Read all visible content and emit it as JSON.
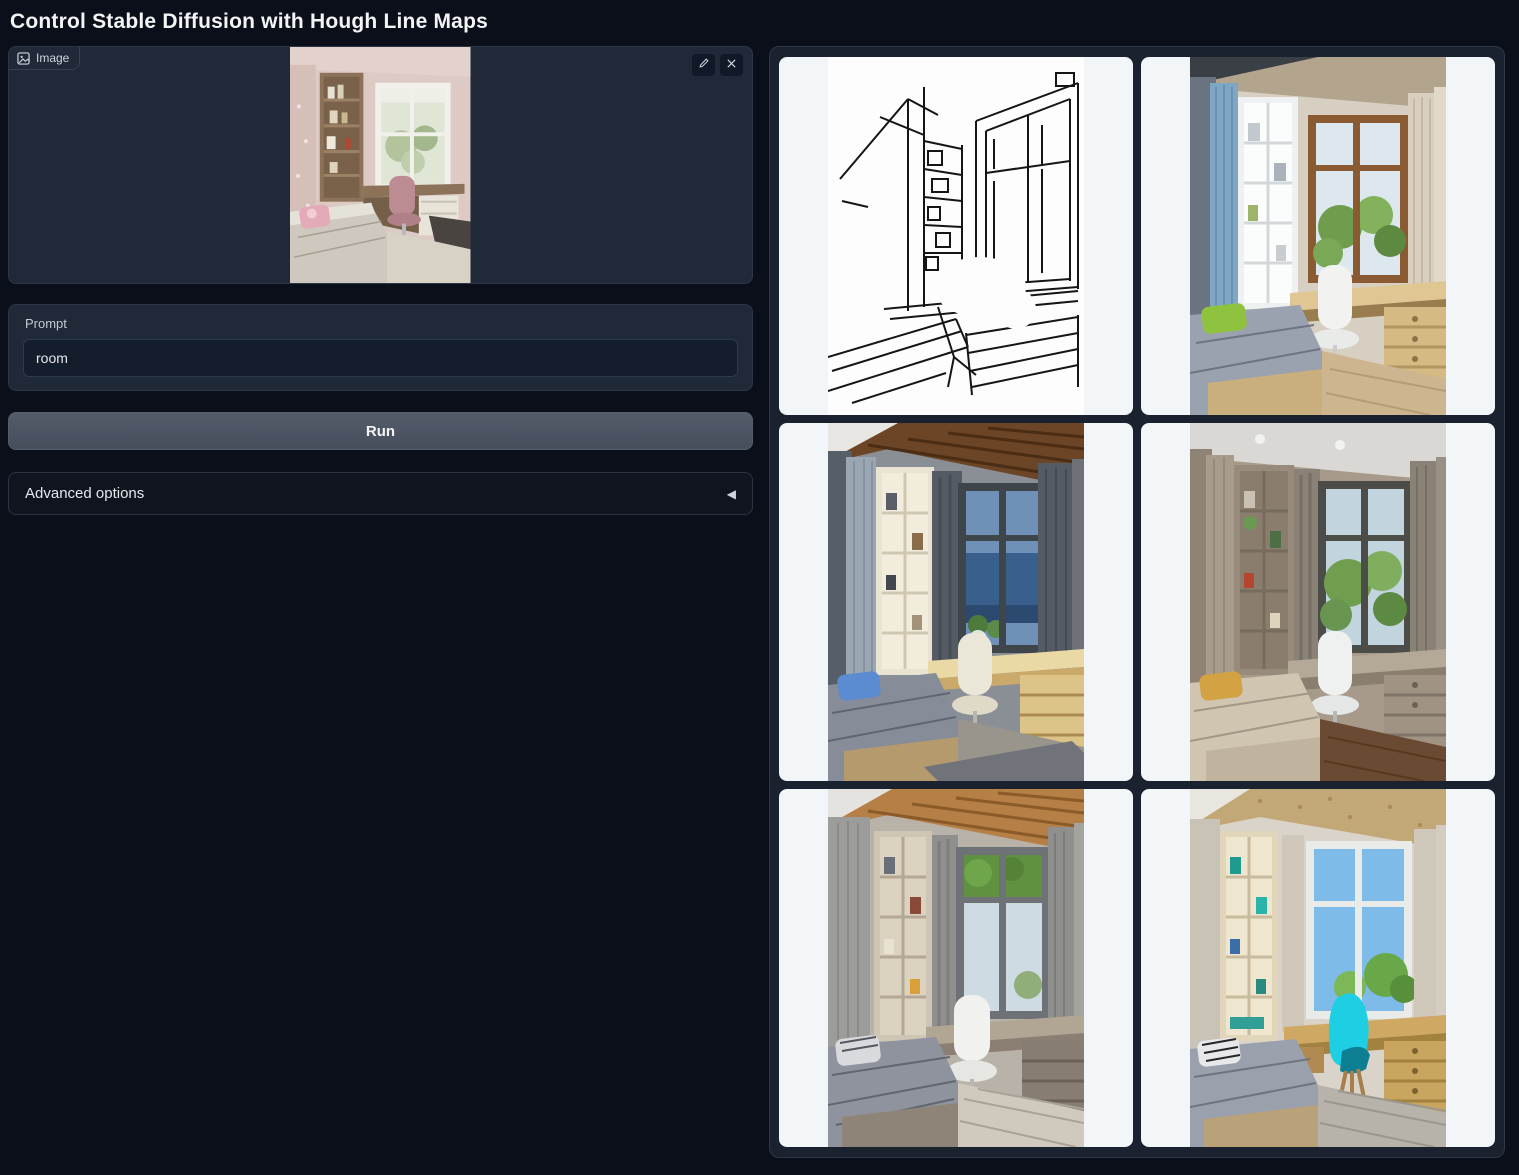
{
  "title": "Control Stable Diffusion with Hough Line Maps",
  "image_block": {
    "label": "Image",
    "edit_icon": "pencil-icon",
    "clear_icon": "x-icon",
    "content": "uploaded-photo-pink-kids-bedroom"
  },
  "prompt_block": {
    "label": "Prompt",
    "value": "room",
    "placeholder": ""
  },
  "run_button": {
    "label": "Run"
  },
  "advanced_options": {
    "label": "Advanced options",
    "arrow_glyph": "◀",
    "state": "collapsed"
  },
  "gallery": {
    "items": [
      {
        "name": "hough-line-map"
      },
      {
        "name": "generated-room-blue-curtains-day"
      },
      {
        "name": "generated-room-dusk-wood-ceiling"
      },
      {
        "name": "generated-room-taupe-green-view"
      },
      {
        "name": "generated-room-warm-wood-ceiling"
      },
      {
        "name": "generated-room-cyan-chair"
      }
    ]
  },
  "colors": {
    "page_bg": "#0b0f19",
    "panel_bg": "#1f2937",
    "input_bg": "#141d2b",
    "border": "#2b3648",
    "run_button": "#4b5563",
    "card_bg": "#f3f6f9",
    "gallery_bg": "#1a2230",
    "accent_cyan_chair": "#1ecfe3"
  }
}
